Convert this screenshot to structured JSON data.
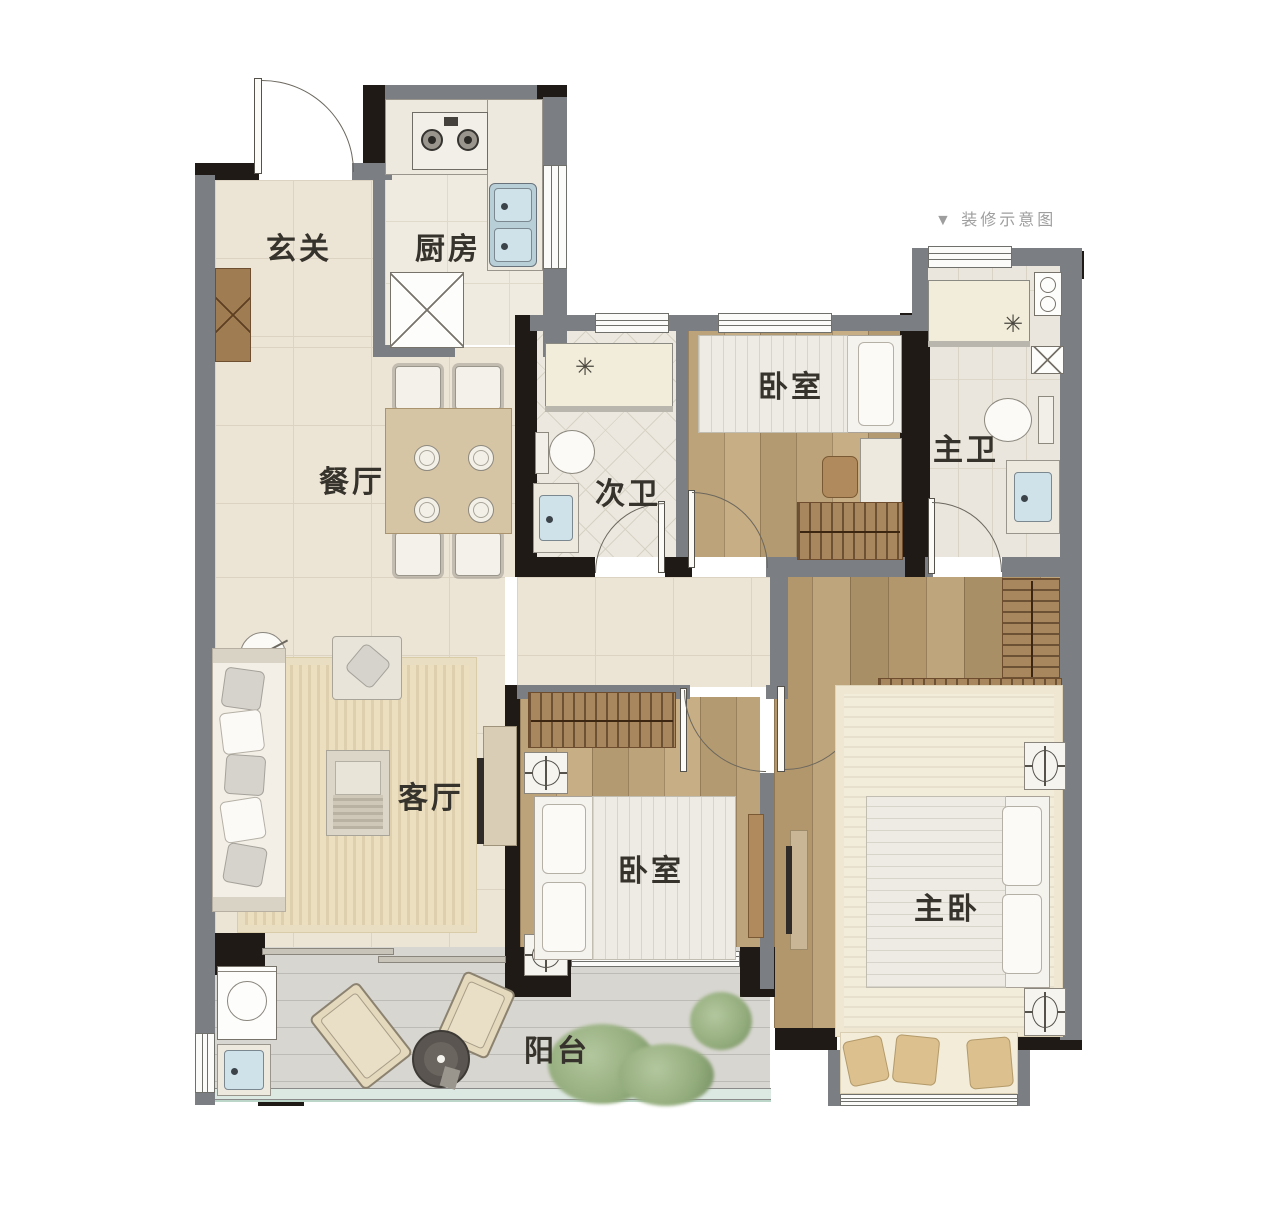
{
  "caption": {
    "text": "▼ 装修示意图"
  },
  "rooms": {
    "foyer": {
      "label": "玄关"
    },
    "kitchen": {
      "label": "厨房"
    },
    "dining": {
      "label": "餐厅"
    },
    "bath_second": {
      "label": "次卫"
    },
    "bedroom_north": {
      "label": "卧室"
    },
    "bath_master": {
      "label": "主卫"
    },
    "living": {
      "label": "客厅"
    },
    "bedroom_second": {
      "label": "卧室"
    },
    "bedroom_master": {
      "label": "主卧"
    },
    "balcony": {
      "label": "阳台"
    }
  },
  "colors": {
    "wall_dark": "#1f1a15",
    "wall_gray": "#7b7e82",
    "floor_tile": "#ece4d5",
    "floor_wood": "#c2a87f",
    "floor_bath": "#ece8df",
    "floor_balcony": "#d8d6d1",
    "wardrobe_wood": "#a8865e",
    "rug": "#ebdfc0",
    "water_fixture": "#cfe2ea",
    "plant": "#93ac7c",
    "label_text": "#36322c",
    "caption_text": "#9e9e9e"
  }
}
